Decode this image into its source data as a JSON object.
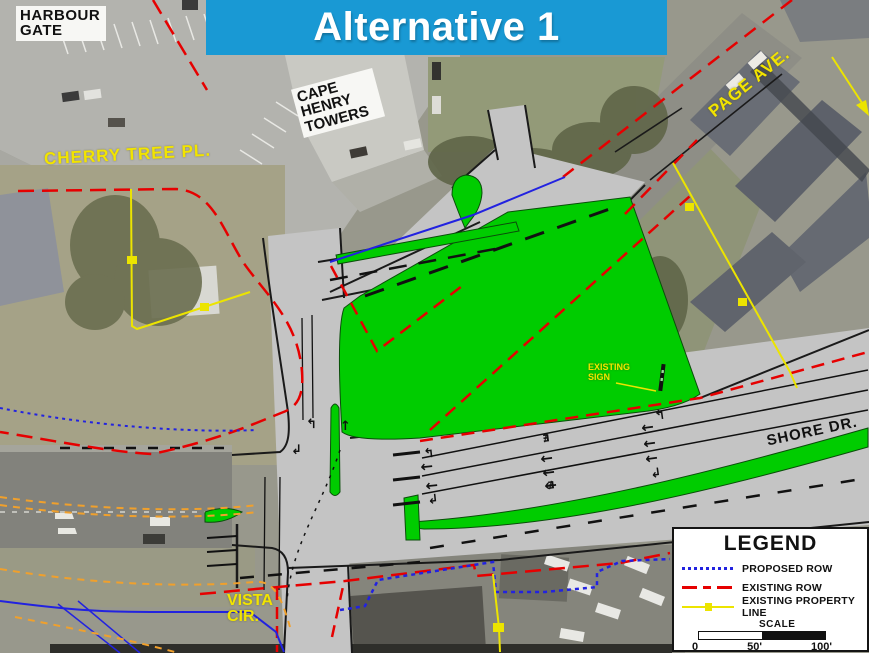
{
  "banner": {
    "title": "Alternative 1",
    "bg_color": "#1999D4",
    "text_color": "#FFFFFF"
  },
  "map_labels": {
    "harbour_gate": "HARBOUR GATE",
    "cape_henry_towers": "CAPE HENRY TOWERS",
    "cherry_tree_pl": "CHERRY TREE PL.",
    "page_ave": "PAGE AVE.",
    "shore_dr": "SHORE DR.",
    "existing_sign": "EXISTING SIGN",
    "vista_cir": "VISTA CIR."
  },
  "legend": {
    "title": "LEGEND",
    "items": [
      {
        "id": "proposed-row",
        "label": "PROPOSED ROW",
        "color": "#2222E0",
        "line_style": "dotted"
      },
      {
        "id": "existing-row",
        "label": "EXISTING ROW",
        "color": "#E60000",
        "line_style": "dashed"
      },
      {
        "id": "existing-property-line",
        "label": "EXISTING PROPERTY LINE",
        "color": "#ECE400",
        "line_style": "solid-with-marker"
      }
    ],
    "scale_label": "SCALE",
    "scale_ticks": [
      "0",
      "50'",
      "100'"
    ]
  },
  "colors": {
    "banner_blue": "#1999D4",
    "proposed_green": "#00CC00",
    "road_gray": "#C4C4C4",
    "existing_row_red": "#E60000",
    "proposed_row_blue": "#2222E0",
    "property_line_yellow": "#ECE400",
    "utility_orange": "#F0A02C",
    "street_label_yellow": "#F2E400"
  }
}
